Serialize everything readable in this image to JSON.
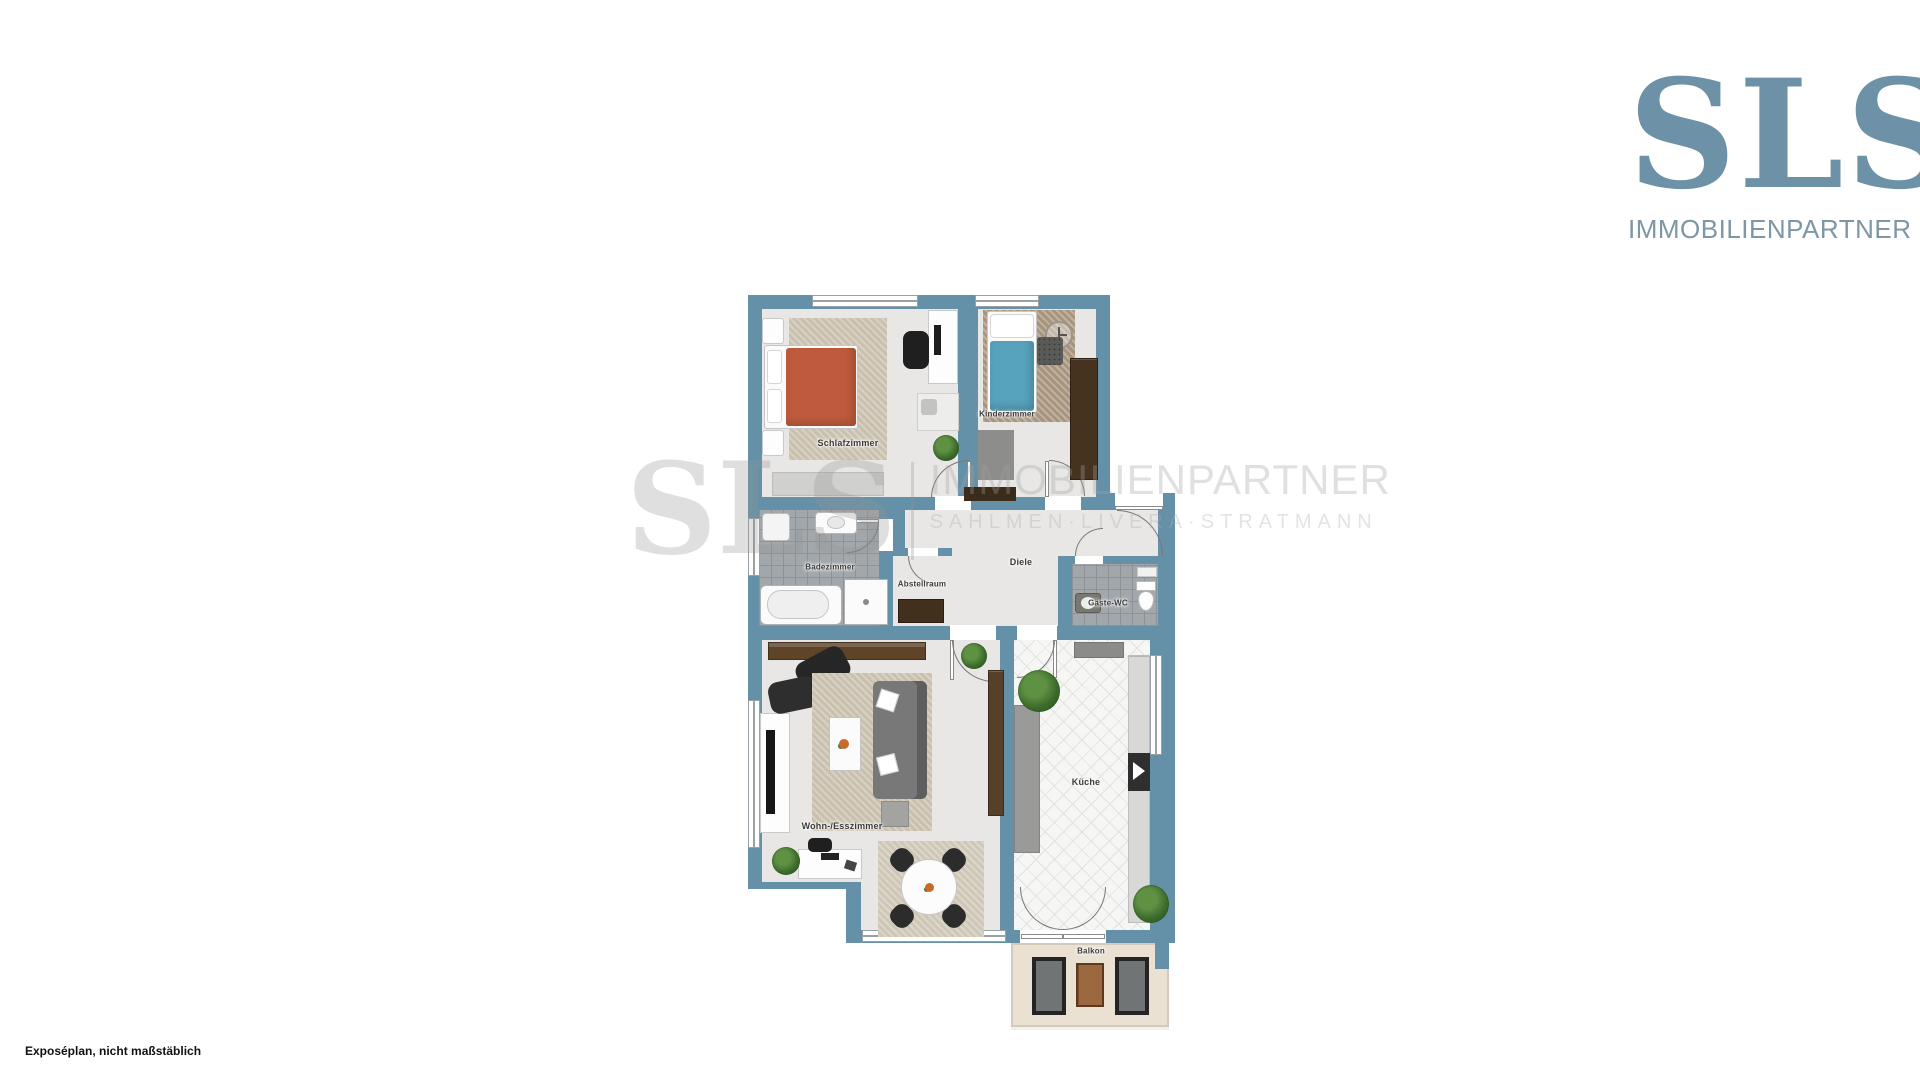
{
  "logo": {
    "text": "SLS",
    "subtitle": "IMMOBILIENPARTNER",
    "color": "#6d92a8"
  },
  "watermark": {
    "text": "SLS",
    "line1": "IMMOBILIENPARTNER",
    "line2": "SAHLMEN·LIVERA·STRATMANN"
  },
  "floorplan": {
    "rooms": [
      {
        "label": "Schlafzimmer"
      },
      {
        "label": "Kinderzimmer"
      },
      {
        "label": "Badezimmer"
      },
      {
        "label": "Abstellraum"
      },
      {
        "label": "Diele"
      },
      {
        "label": "Gäste-WC"
      },
      {
        "label": "Wohn-/Esszimmer"
      },
      {
        "label": "Küche"
      },
      {
        "label": "Balkon"
      }
    ],
    "colors": {
      "wall": "#6491a8",
      "floor": "#e8e7e5",
      "bath_tile": "#a2a7ab",
      "kitchen_tile": "#f6f6f5",
      "rug_beige": "#c9c0ae",
      "rug_brown": "#a8947d",
      "bed_orange": "#bf5a3c",
      "bed_blue": "#57a2bd",
      "wood_dark": "#46331f",
      "balcony_floor": "#eae1d3"
    }
  },
  "footer": {
    "note": "Exposéplan, nicht maßstäblich"
  }
}
